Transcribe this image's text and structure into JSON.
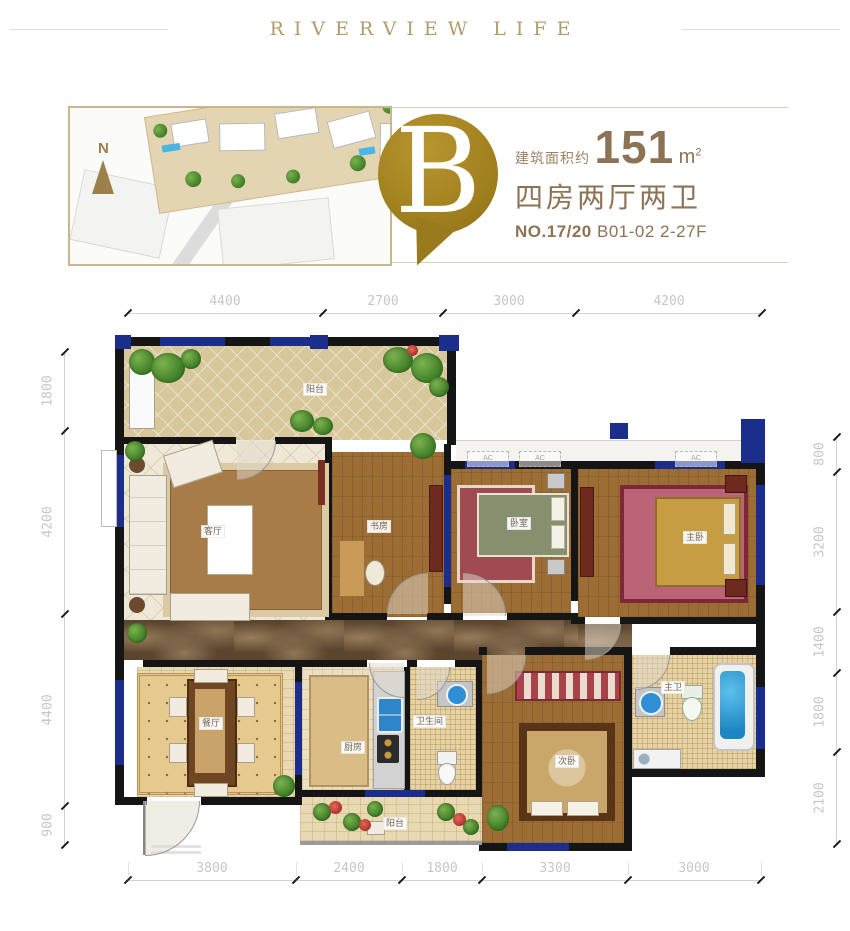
{
  "header": {
    "title": "RIVERVIEW LIFE"
  },
  "unit": {
    "badge_letter": "B",
    "compass": "N",
    "area_label": "建筑面积约",
    "area_value": "151",
    "area_unit": "m",
    "area_sup": "2",
    "layout": "四房两厅两卫",
    "number": "NO.17/20",
    "detail": "B01-02 2-27F"
  },
  "dims": {
    "top": [
      "4400",
      "2700",
      "3000",
      "4200"
    ],
    "bottom": [
      "3800",
      "2400",
      "1800",
      "3300",
      "3000"
    ],
    "left": [
      "1800",
      "4200",
      "4400",
      "900"
    ],
    "right": [
      "800",
      "3200",
      "1400",
      "1800",
      "2100"
    ]
  },
  "rooms": {
    "terrace": "阳台",
    "living": "客厅",
    "study": "书房",
    "bedroom2": "卧室",
    "master": "主卧",
    "dining": "餐厅",
    "kitchen": "厨房",
    "bath": "卫生间",
    "bedroom3": "次卧",
    "master_bath": "主卫",
    "balcony": "阳台"
  },
  "ac_label": "AC",
  "colors": {
    "accent_gold": "#a1801f",
    "text_brown": "#8d7355",
    "wall_black": "#151515",
    "window_blue": "#1c2e8c",
    "dim_gray": "#c6c6c6"
  }
}
